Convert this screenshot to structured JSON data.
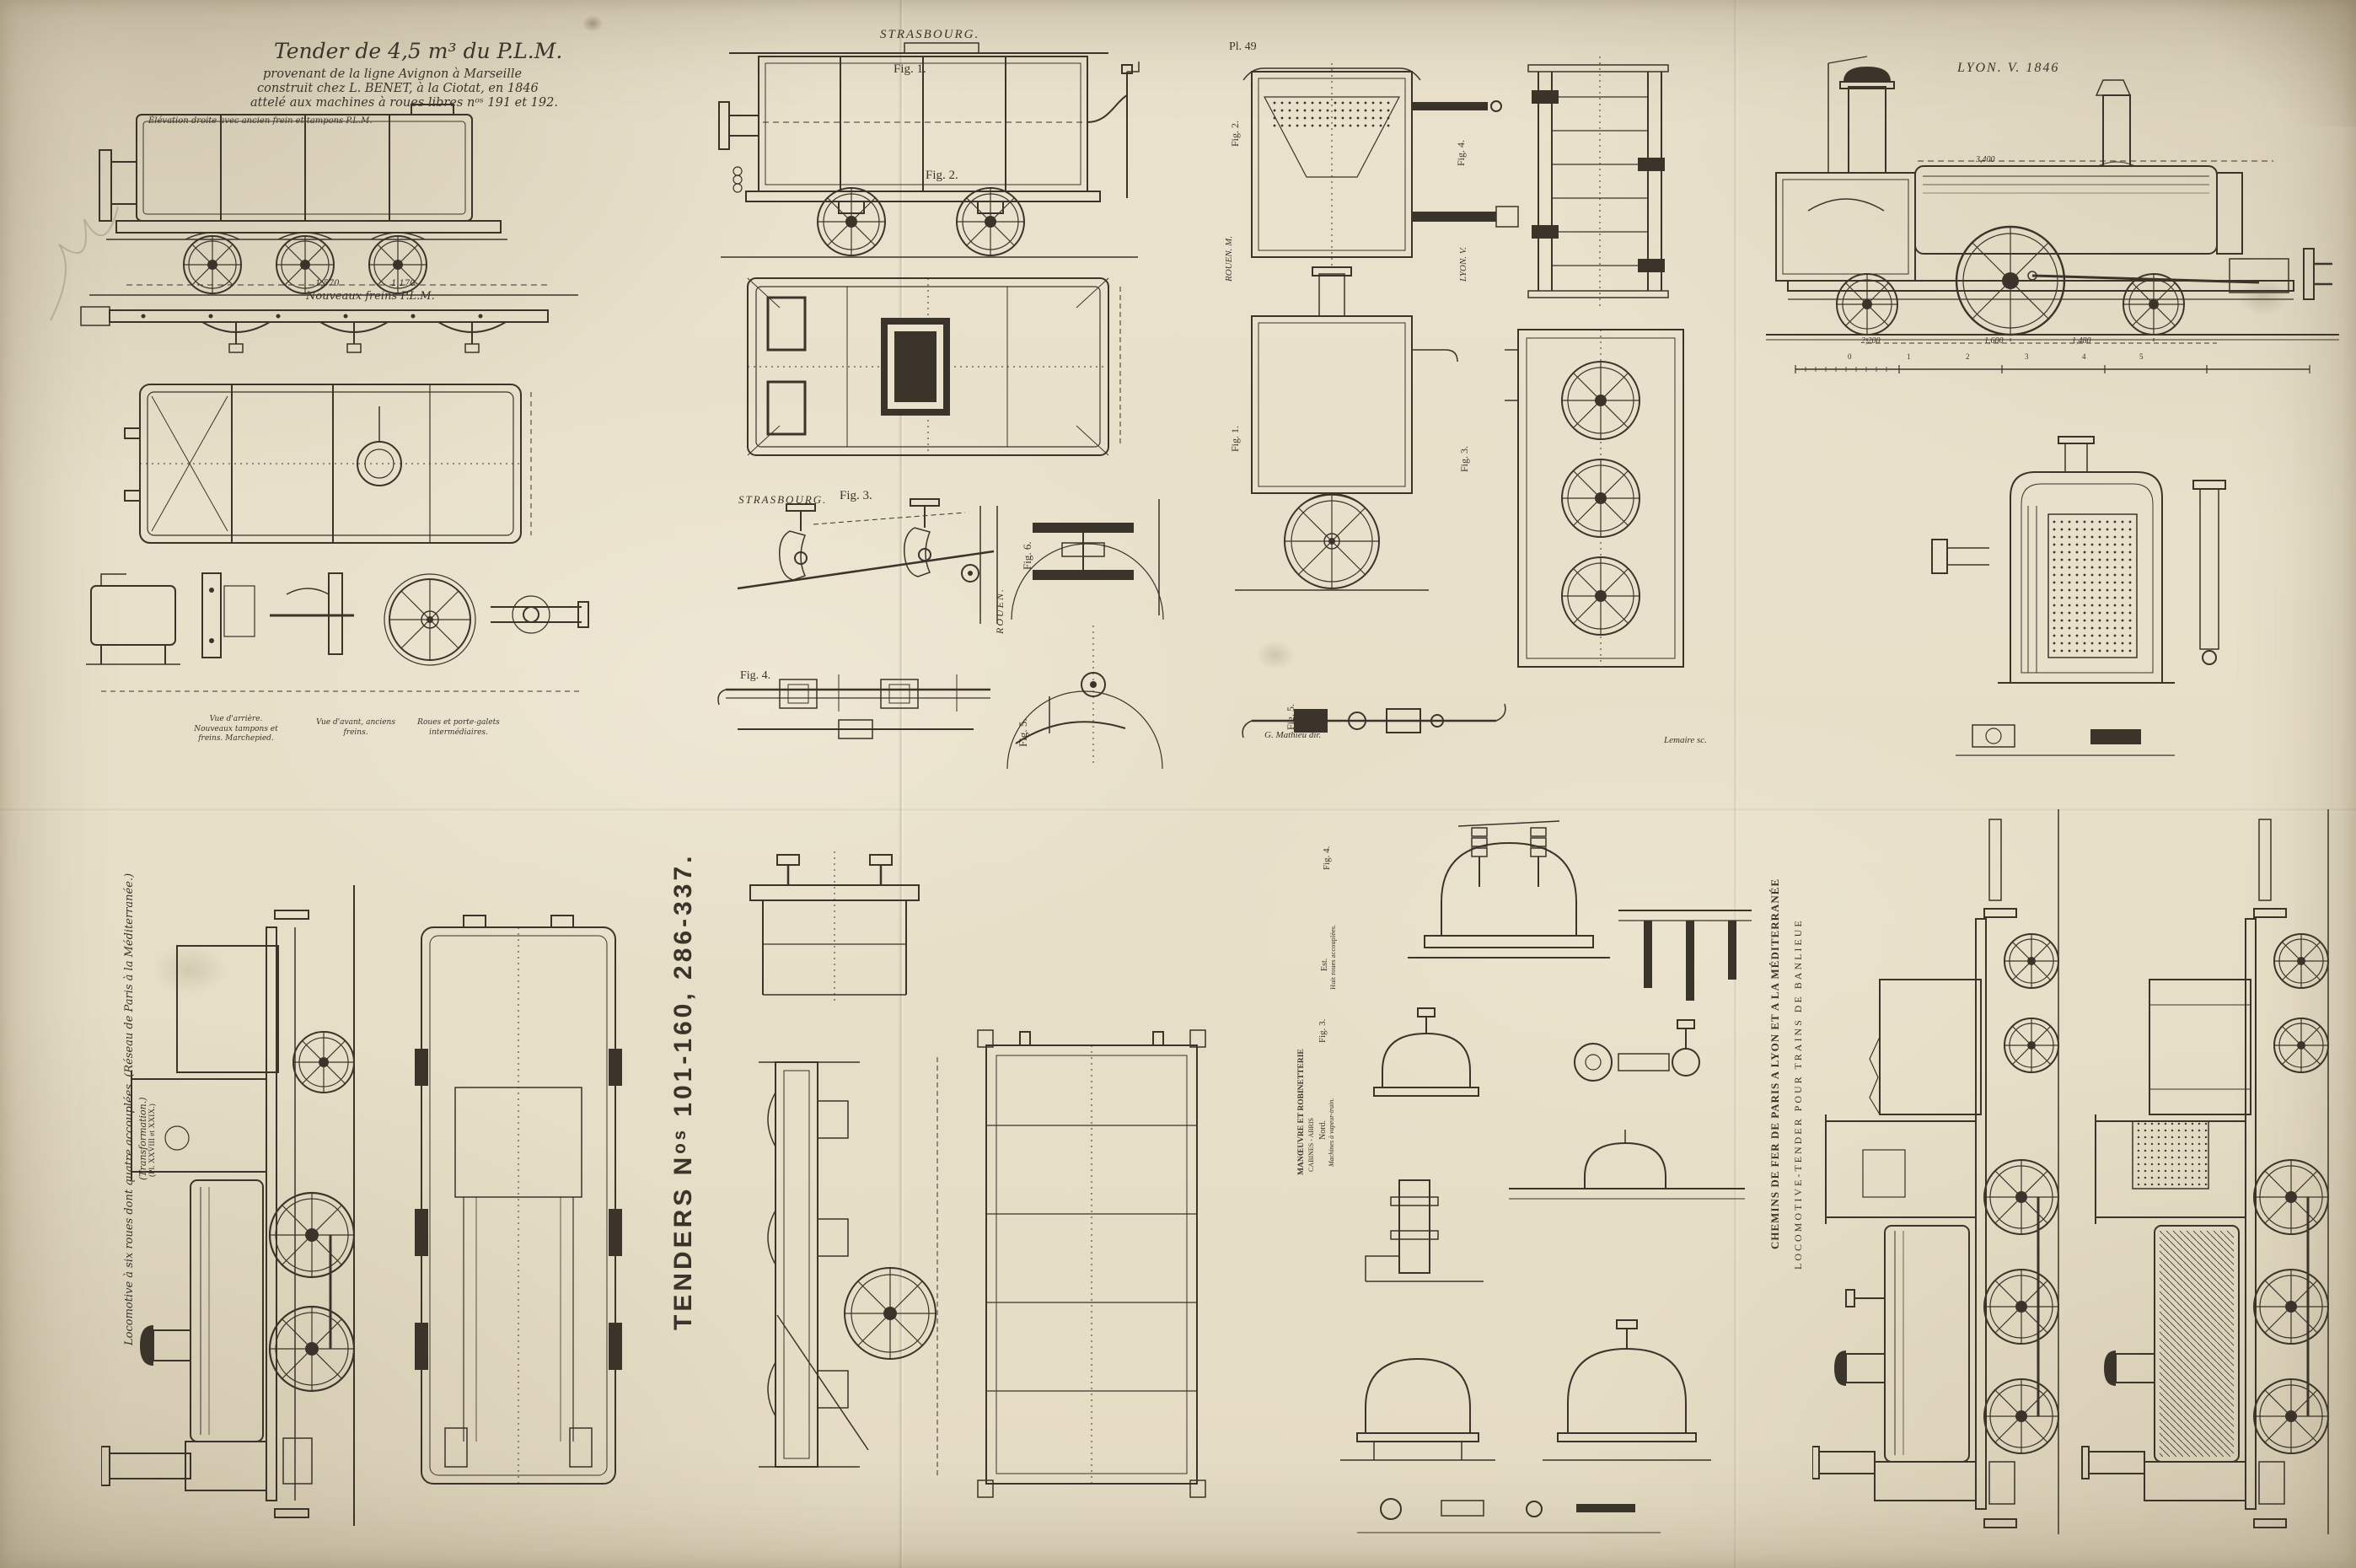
{
  "paper": {
    "bg": "#eae2cd",
    "ink": "#3a342b"
  },
  "plm": {
    "title1": "Tender de 4,5 m³ du P.L.M.",
    "title2": "provenant de la ligne Avignon à Marseille",
    "title3": "construit chez L. BENET, à la Ciotat, en 1846",
    "title4": "attelé aux machines à roues libres nᵒˢ 191 et 192.",
    "cap_elevation": "Élévation droite avec ancien frein et tampons P.L.M.",
    "lbl_new_brakes": "Nouveaux freins P.L.M.",
    "dim_a": "1,570",
    "dim_b": "1,170",
    "cap_rear": "Vue d'arrière. Nouveaux tampons et freins. Marchepied.",
    "cap_front": "Vue d'avant, anciens freins.",
    "cap_wheels": "Roues et porte-galets intermédiaires."
  },
  "strasbourg": {
    "title": "STRASBOURG.",
    "fig1": "Fig. 1.",
    "fig2": "Fig. 2.",
    "title3": "STRASBOURG.",
    "fig3": "Fig. 3.",
    "fig4": "Fig. 4.",
    "fig5": "Fig. 5.",
    "fig6": "Fig. 6.",
    "rouen": "ROUEN."
  },
  "pl49": {
    "plate_no": "Pl. 49",
    "fig1": "Fig. 1.",
    "fig2": "Fig. 2.",
    "fig3": "Fig. 3.",
    "fig4": "Fig. 4.",
    "fig5": "Fig. 5.",
    "rouen_m": "ROUEN. M.",
    "lyon_v": "LYON. V.",
    "credit_dir": "G. Mathieu dir.",
    "credit_sc": "Lemaire sc."
  },
  "lyon": {
    "title": "LYON.  V. 1846",
    "dim_top": "3,400",
    "dim_1": "2,200",
    "dim_2": "1,600",
    "dim_3": "1,480",
    "scale": [
      "0",
      "1",
      "2",
      "3",
      "4",
      "5"
    ]
  },
  "tenders_title": "TENDERS  Nᵒˢ 101-160, 286-337.",
  "southeast": {
    "cap1": "Locomotive à six roues dont quatre accouplées. (Réseau de Paris à la Méditerranée.)",
    "cap2": "(Transformation.)",
    "cap3": "(Pl. XXVIII et XXIX.)"
  },
  "fittings": {
    "cap1": "MANŒUVRE ET ROBINETTERIE",
    "cap2": "CABINES - ABRIS",
    "nord": "Nord.",
    "nord_sub": "Machines à vapeur-train.",
    "est": "Est.",
    "est_sub": "Huit roues accouplées.",
    "fig3": "Fig. 3.",
    "fig4": "Fig. 4."
  },
  "plm_banlieue": {
    "line1": "CHEMINS DE FER DE PARIS A LYON ET A LA MÉDITERRANÉE",
    "line2": "LOCOMOTIVE-TENDER POUR TRAINS DE BANLIEUE"
  }
}
